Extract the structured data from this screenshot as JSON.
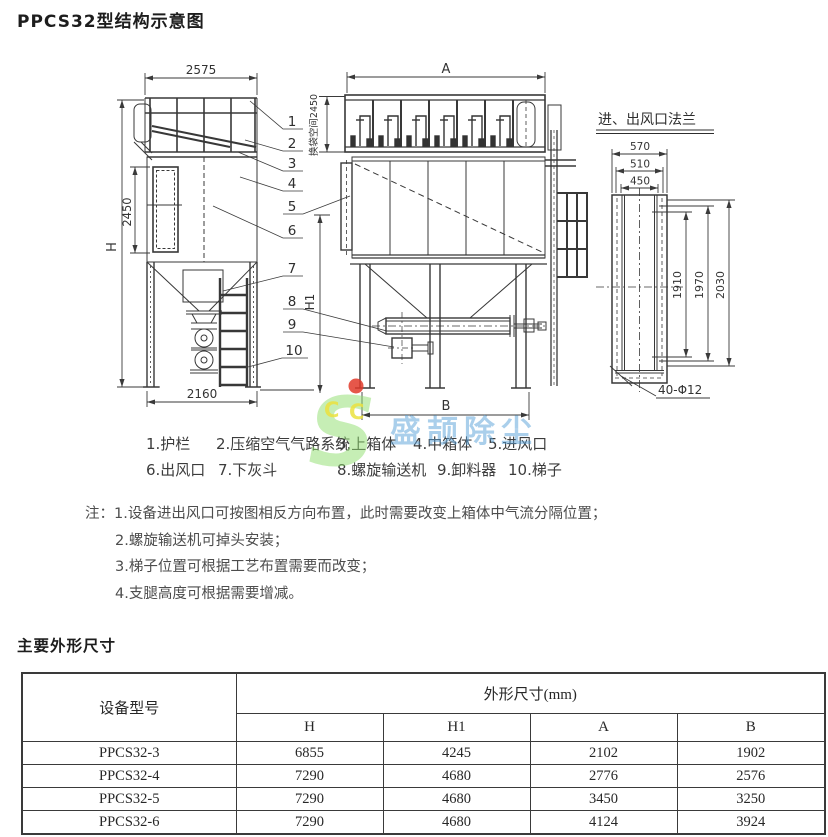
{
  "page": {
    "title": "PPCS32型结构示意图",
    "section2_title": "主要外形尺寸"
  },
  "drawing": {
    "side": {
      "dim_top": "2575",
      "dim_height": "H",
      "dim_body": "2450",
      "dim_bottom": "2160"
    },
    "front": {
      "dim_top": "A",
      "dim_bag_space": "换袋空间2450",
      "dim_h1": "H1",
      "dim_bottom": "B"
    },
    "flange": {
      "title": "进、出风口法兰",
      "dim_w_outer": "570",
      "dim_w_mid": "510",
      "dim_w_inner": "450",
      "dim_v1": "1910",
      "dim_v2": "1970",
      "dim_v3": "2030",
      "bolt_note": "40-Φ12"
    },
    "callouts": [
      "1",
      "2",
      "3",
      "4",
      "5",
      "6",
      "7",
      "8",
      "9",
      "10"
    ]
  },
  "legend": {
    "row1": [
      "1.护栏",
      "2.压缩空气气路系统",
      "3.上箱体",
      "4.中箱体",
      "5.进风口"
    ],
    "row2": [
      "6.出风口",
      "7.下灰斗",
      "8.螺旋输送机",
      "9.卸料器",
      "10.梯子"
    ]
  },
  "notes": {
    "prefix": "注：",
    "items": [
      "1.设备进出风口可按图相反方向布置，此时需要改变上箱体中气流分隔位置；",
      "2.螺旋输送机可掉头安装；",
      "3.梯子位置可根据工艺布置需要而改变；",
      "4.支腿高度可根据需要增减。"
    ]
  },
  "table": {
    "col_model": "设备型号",
    "col_group": "外形尺寸(mm)",
    "sub_cols": [
      "H",
      "H1",
      "A",
      "B"
    ],
    "rows": [
      {
        "model": "PPCS32-3",
        "H": "6855",
        "H1": "4245",
        "A": "2102",
        "B": "1902"
      },
      {
        "model": "PPCS32-4",
        "H": "7290",
        "H1": "4680",
        "A": "2776",
        "B": "2576"
      },
      {
        "model": "PPCS32-5",
        "H": "7290",
        "H1": "4680",
        "A": "3450",
        "B": "3250"
      },
      {
        "model": "PPCS32-6",
        "H": "7290",
        "H1": "4680",
        "A": "4124",
        "B": "3924"
      }
    ]
  },
  "watermark": {
    "logo_letter": "S",
    "letters_c1": "C",
    "letters_c2": "C",
    "text": "盛颉除尘",
    "green": "#8ede6e",
    "blue": "#57a0d8",
    "red": "#e23a2a",
    "yellow": "#ece23f"
  }
}
